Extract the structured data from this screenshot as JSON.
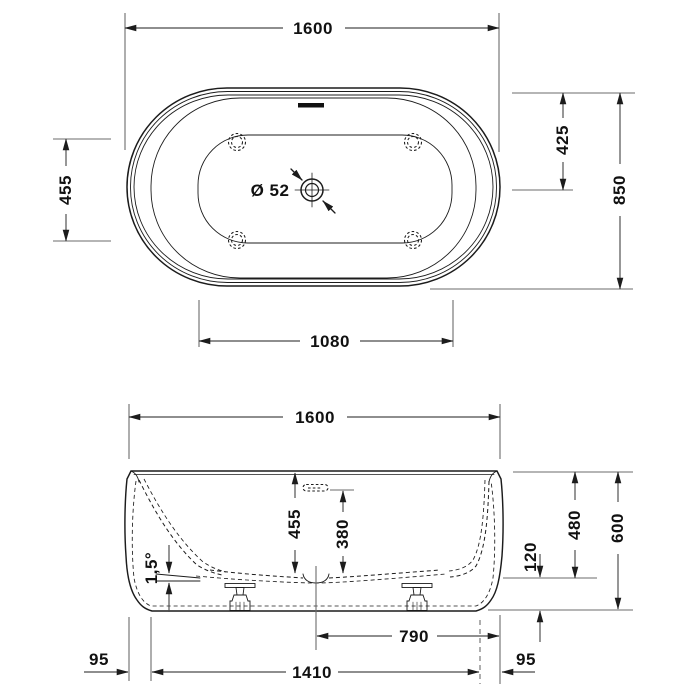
{
  "top_view": {
    "width": "1600",
    "feet_spacing": "455",
    "rim_to_drain": "425",
    "depth": "850",
    "floor_length": "1080",
    "drain_diameter": "Ø 52"
  },
  "side_view": {
    "width": "1600",
    "inner_depth": "455",
    "overflow_height": "380",
    "floor_slope": "1,5°",
    "base_gap": "120",
    "inner_floor_height": "480",
    "total_height": "600",
    "center_to_edge": "790",
    "base_length": "1410",
    "left_inset": "95",
    "right_inset": "95"
  }
}
